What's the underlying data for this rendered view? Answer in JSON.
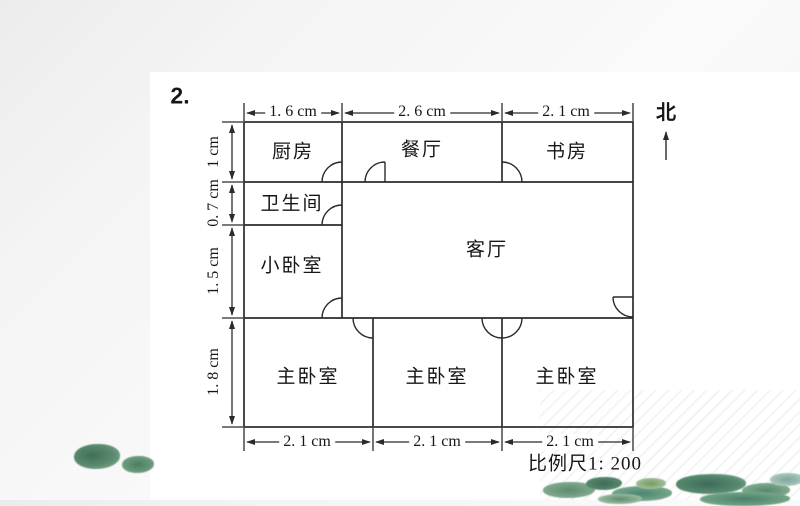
{
  "colors": {
    "wall_line": "#2b2b2b",
    "leaf_dark_teal": "#3e6b5a",
    "leaf_green": "#5d8b6f",
    "leaf_sage": "#a9c9af",
    "leaf_olive": "#7a9a5f"
  },
  "slide": {
    "item_number": "2.",
    "north_label": "北",
    "scale_label": "比例尺1: 200"
  },
  "floor_plan": {
    "rooms": [
      {
        "name": "厨房"
      },
      {
        "name": "餐厅"
      },
      {
        "name": "书房"
      },
      {
        "name": "卫生间"
      },
      {
        "name": "小卧室"
      },
      {
        "name": "客厅"
      },
      {
        "name": "主卧室"
      },
      {
        "name": "主卧室"
      },
      {
        "name": "主卧室"
      }
    ],
    "dims_top": [
      "1. 6 cm",
      "2. 6 cm",
      "2. 1 cm"
    ],
    "dims_left": [
      "1 cm",
      "0. 7 cm",
      "1. 5 cm",
      "1. 8 cm"
    ],
    "dims_bottom": [
      "2. 1 cm",
      "2. 1 cm",
      "2. 1 cm"
    ]
  }
}
